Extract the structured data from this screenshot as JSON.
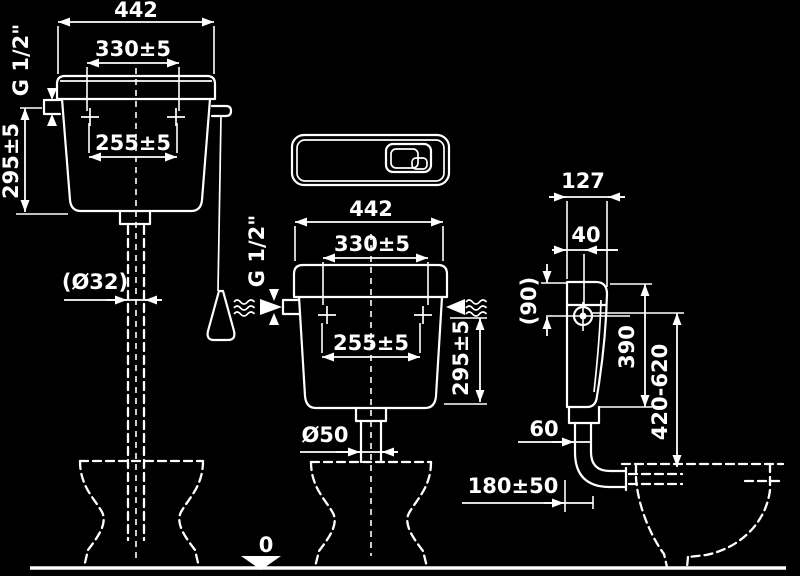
{
  "colors": {
    "background": "#000000",
    "line": "#ffffff"
  },
  "views": {
    "left_front": {
      "width": "442",
      "upper_hole_spacing": "330±5",
      "lower_hole_spacing": "255±5",
      "height": "295±5",
      "inlet_thread": "G 1/2\"",
      "flush_pipe_diameter": "(Ø32)"
    },
    "middle_front": {
      "width": "442",
      "upper_hole_spacing": "330±5",
      "lower_hole_spacing": "255±5",
      "height": "295±5",
      "inlet_thread": "G 1/2\"",
      "flush_pipe_diameter": "Ø50"
    },
    "side": {
      "depth": "127",
      "inlet_offset": "40",
      "top_to_inlet": "(90)",
      "height": "390",
      "inlet_height_range": "420-620",
      "outlet_offset": "60",
      "wall_clearance": "180±50"
    },
    "floor_level": "0"
  }
}
